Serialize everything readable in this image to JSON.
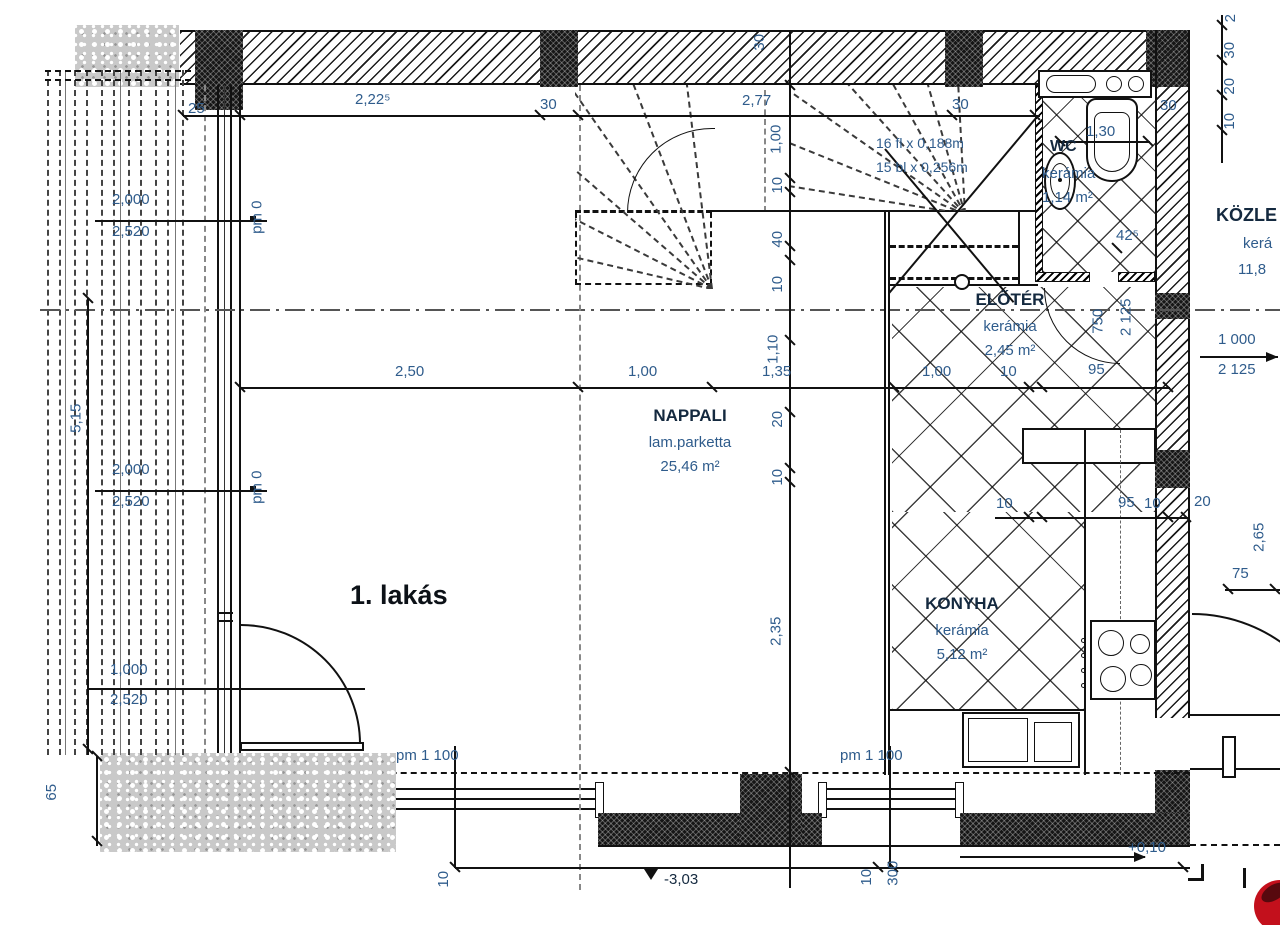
{
  "drawing": {
    "title": "1. lakás",
    "rooms": {
      "nappali": {
        "name": "NAPPALI",
        "floor": "lam.parketta",
        "area": "25,46 m²"
      },
      "eloter": {
        "name": "ELŐTÉR",
        "floor": "kerámia",
        "area": "2,45 m²"
      },
      "konyha": {
        "name": "KONYHA",
        "floor": "kerámia",
        "area": "5,12 m²"
      },
      "wc": {
        "name": "WC",
        "floor": "kerámia",
        "area": "1,14 m²"
      },
      "kozlekedo": {
        "name": "KÖZLE",
        "floor": "kerá",
        "area": "11,8"
      }
    },
    "stairs": {
      "note1": "16 fl x 0,188m",
      "note2": "15 bl x 0,256m"
    },
    "levels": {
      "pm0": "pm 0",
      "pm1100": "pm 1 100",
      "minus": "-3,03",
      "plus": "+0,10"
    },
    "dims": {
      "top": [
        "25",
        "2,22⁵",
        "30",
        "2,77",
        "30",
        "30",
        "30"
      ],
      "right_top": [
        "2",
        "30",
        "20",
        "10"
      ],
      "left_pairs": [
        [
          "2,000",
          "2,520"
        ],
        [
          "2,000",
          "2,520"
        ],
        [
          "1,000",
          "2,520"
        ]
      ],
      "left_height": "5,15",
      "left_base": "65",
      "mid": [
        "2,50",
        "1,00",
        "1,35",
        "1,00",
        "10",
        "95"
      ],
      "v_chain": [
        "1,00",
        "10",
        "40",
        "10",
        "1,10",
        "20",
        "10",
        "2,35"
      ],
      "wc": [
        "1,30",
        "42⁵"
      ],
      "door_wc": [
        "750",
        "2 125"
      ],
      "right_door": [
        "1 000",
        "2 125"
      ],
      "kitchen": [
        "10",
        "95",
        "10",
        "20"
      ],
      "right_low": [
        "2,65",
        "75"
      ],
      "bottom": [
        "10",
        "10",
        "300"
      ]
    },
    "colors": {
      "accent_red": "#c3101c",
      "dim_blue": "#2f5c8c",
      "ink": "#111111"
    }
  }
}
